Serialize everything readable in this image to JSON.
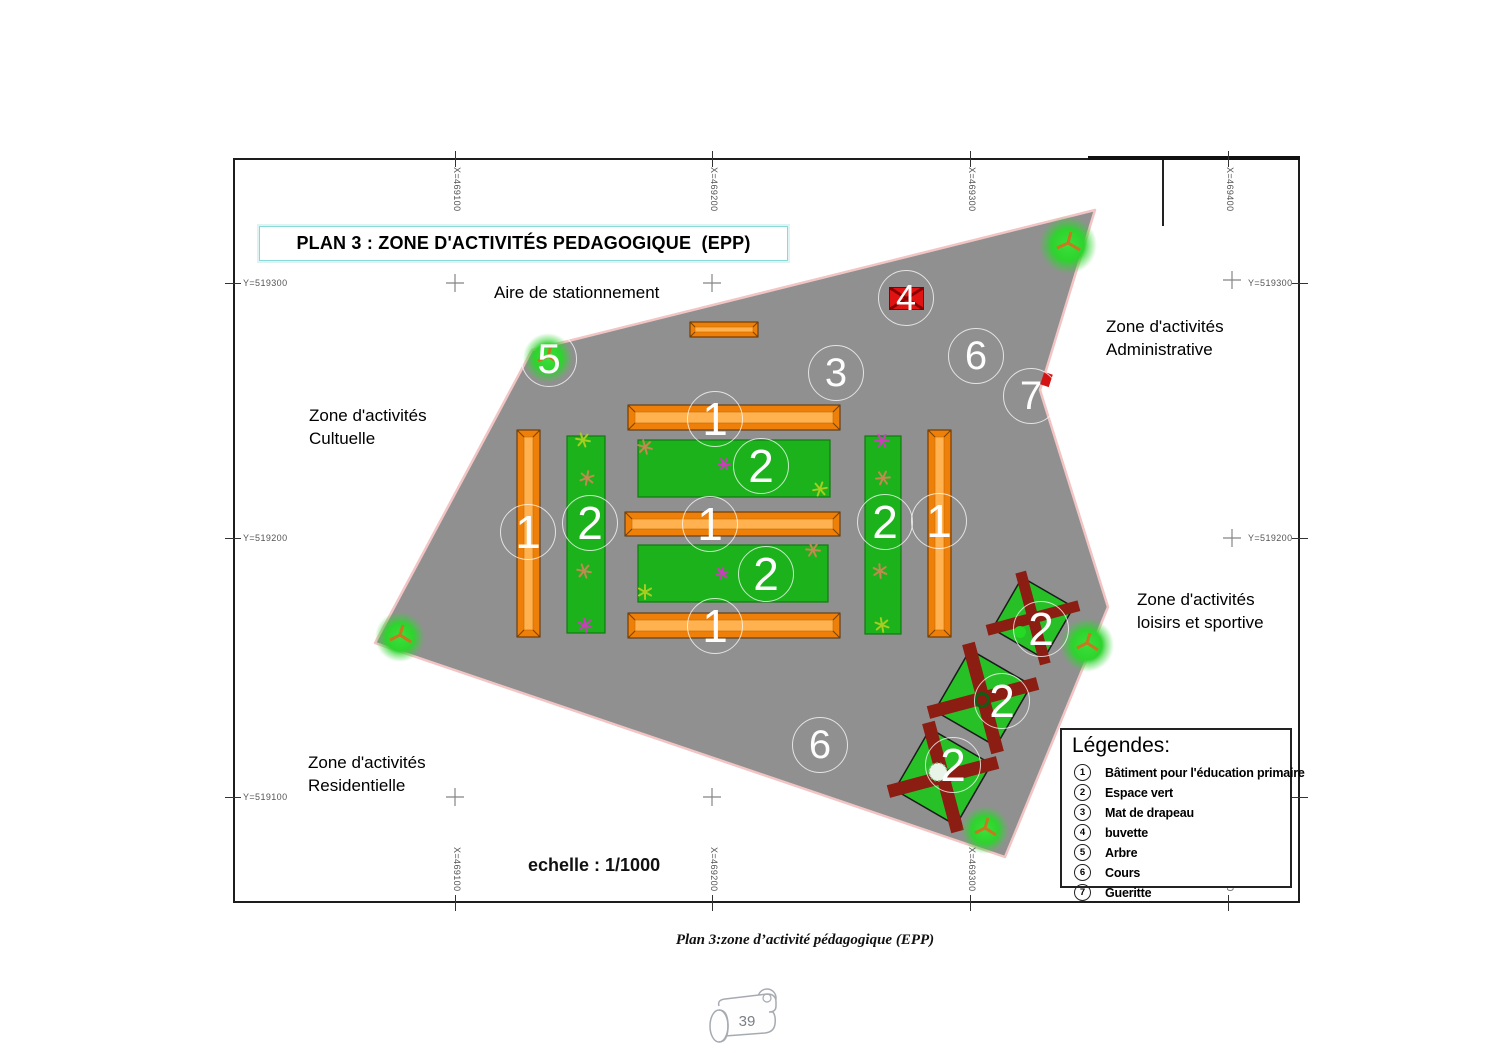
{
  "plan": {
    "title": "PLAN 3 : ZONE D'ACTIVITÉS PEDAGOGIQUE  (EPP)",
    "scale_label": "echelle : 1/1000",
    "area_labels": {
      "parking": "Aire de stationnement",
      "admin_l1": "Zone d'activités",
      "admin_l2": "Administrative",
      "cult_l1": "Zone d'activités",
      "cult_l2": "Cultuelle",
      "sport_l1": "Zone d'activités",
      "sport_l2": "loisirs et sportive",
      "resid_l1": "Zone d'activités",
      "resid_l2": "Residentielle"
    },
    "grid": {
      "x_labels": [
        "X=469100",
        "X=469200",
        "X=469300",
        "X=469400"
      ],
      "y_labels": [
        "Y=519300",
        "Y=519200",
        "Y=519100"
      ]
    },
    "marker_symbols": {
      "batiment": "1",
      "espace_vert": "2",
      "mat_de_drapeau": "3",
      "buvette": "4",
      "arbre": "5",
      "cours": "6",
      "gueritte": "7"
    }
  },
  "legend": {
    "title": "Légendes:",
    "items": [
      {
        "num": "1",
        "label": "Bâtiment pour l'éducation primaire"
      },
      {
        "num": "2",
        "label": "Espace vert"
      },
      {
        "num": "3",
        "label": "Mat de drapeau"
      },
      {
        "num": "4",
        "label": "buvette"
      },
      {
        "num": "5",
        "label": "Arbre"
      },
      {
        "num": "6",
        "label": "Cours"
      },
      {
        "num": "7",
        "label": "Gueritte"
      }
    ]
  },
  "caption": "Plan 3:zone d’activité pédagogique (EPP)",
  "page_number": "39",
  "colors": {
    "plan_fill": "#909090",
    "plan_border": "#f2c4c4",
    "building_orange": "#ee8009",
    "green": "#1cb21c",
    "field_cross": "#8c1d12",
    "buvette_red": "#e01212",
    "title_border": "#8adbd8"
  }
}
